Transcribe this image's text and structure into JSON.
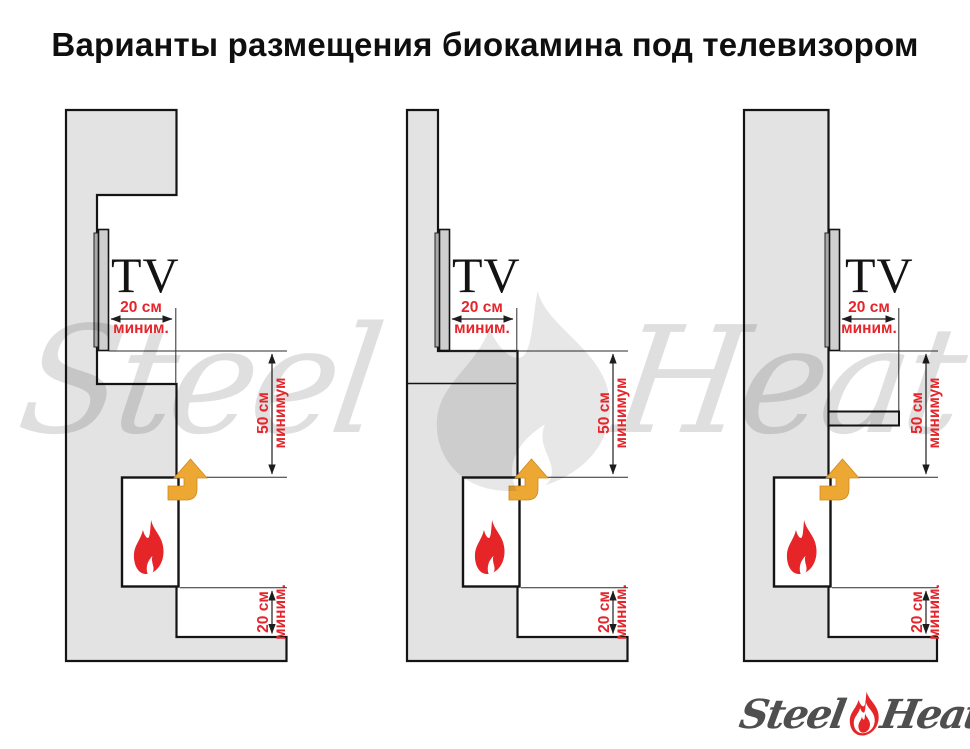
{
  "title": "Варианты размещения биокамина под телевизором",
  "labels": {
    "tv": "TV",
    "tv_gap_value": "20 см",
    "tv_gap_min": "миним.",
    "height_value": "50 см",
    "height_min": "минимум",
    "floor_gap_value": "20 см",
    "floor_gap_min": "миним."
  },
  "watermark": {
    "left_word": "Steel",
    "right_word": "Heat"
  },
  "logo": {
    "left_word": "Steel",
    "right_word": "Heat"
  },
  "colors": {
    "accent_red": "#e4252b",
    "flame_red": "#e52528",
    "arrow_gold": "#eda733",
    "wall_gray": "#e3e3e3",
    "outline_black": "#141414",
    "logo_gray": "#4f4f4f"
  }
}
